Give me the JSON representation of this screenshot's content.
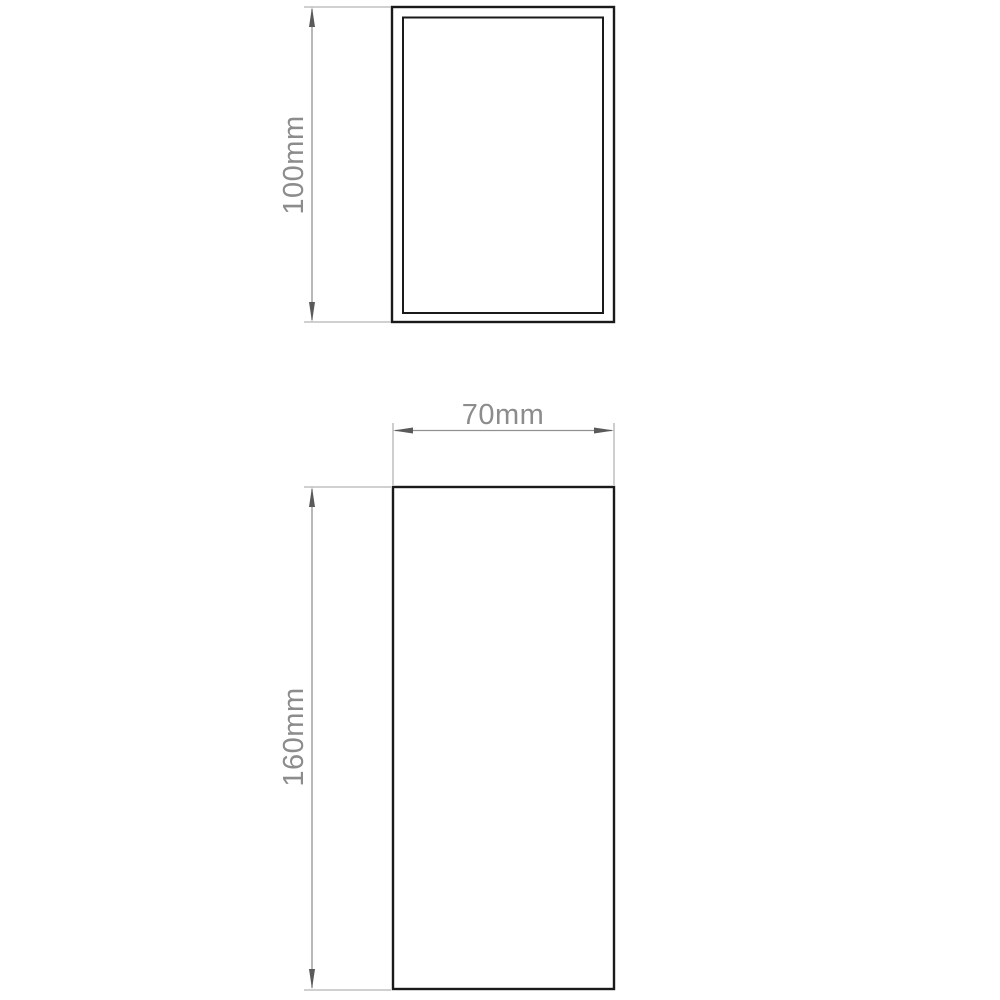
{
  "diagram": {
    "type": "technical-dimension-drawing",
    "views": {
      "top_view": {
        "shape": "rectangle-with-inner-outline"
      },
      "front_view": {
        "shape": "rectangle"
      }
    },
    "dimensions": {
      "top_view_height": {
        "label": "100mm",
        "orientation": "vertical"
      },
      "front_view_width": {
        "label": "70mm",
        "orientation": "horizontal"
      },
      "front_view_height": {
        "label": "160mm",
        "orientation": "vertical"
      }
    },
    "colors": {
      "outline": "#1a1a1a",
      "dimension_line": "#919191",
      "extension_line": "#b3b3b3",
      "arrowhead": "#5a5a5a",
      "label": "#8c8c8c",
      "background": "#ffffff"
    }
  }
}
